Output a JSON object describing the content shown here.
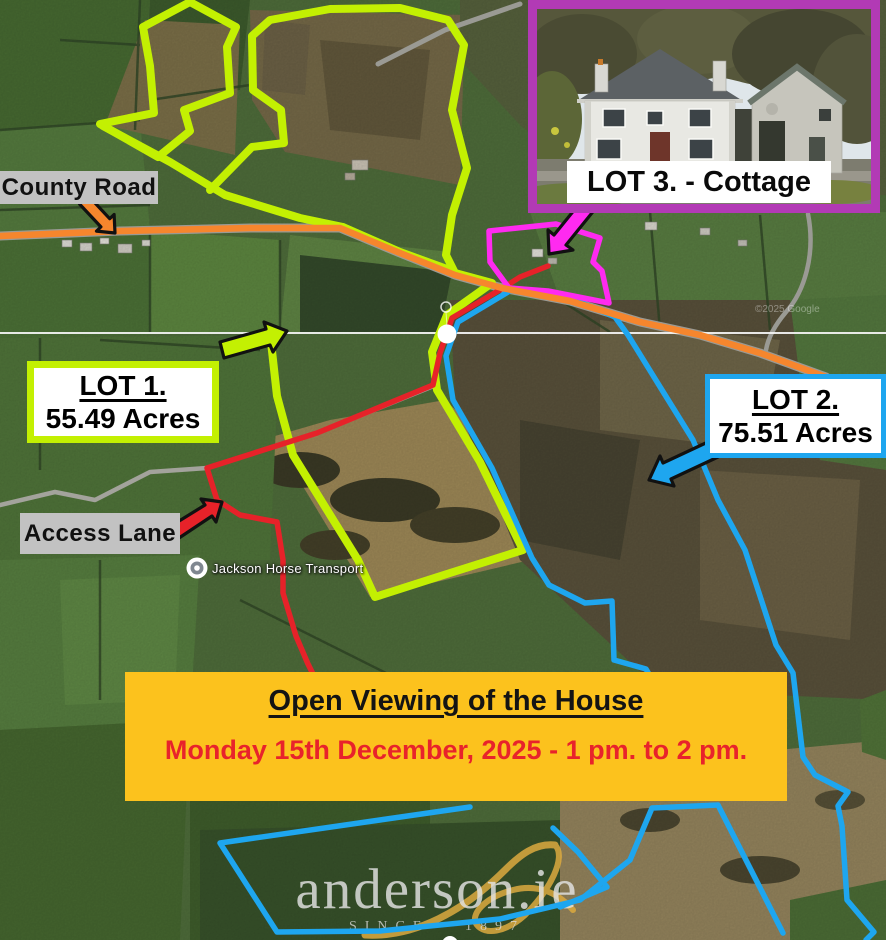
{
  "labels": {
    "county_road": "County Road",
    "access_lane": "Access Lane"
  },
  "lot1": {
    "title": "LOT 1.",
    "area": "55.49 Acres"
  },
  "lot2": {
    "title": "LOT 2.",
    "area": "75.51 Acres"
  },
  "lot3": {
    "label": "LOT 3. - Cottage"
  },
  "poi": {
    "label": "Jackson Horse Transport"
  },
  "banner": {
    "title": "Open Viewing of the House",
    "schedule": "Monday 15th December, 2025 - 1 pm. to 2 pm."
  },
  "watermark": {
    "brand": "anderson.ie",
    "tagline": "SINCE · 1897"
  },
  "attribution": "©2025 Google",
  "colors": {
    "lot1_outline": "#c3f002",
    "lot2_outline": "#1ea6ef",
    "lot3_outline": "#ff2af0",
    "inset_frame": "#b23ab5",
    "road_highlight": "#f6862d",
    "access_route": "#e62229",
    "banner_bg": "#fcc21d",
    "banner_date_color": "#e8232b",
    "label_bg": "#c2c2c2"
  }
}
